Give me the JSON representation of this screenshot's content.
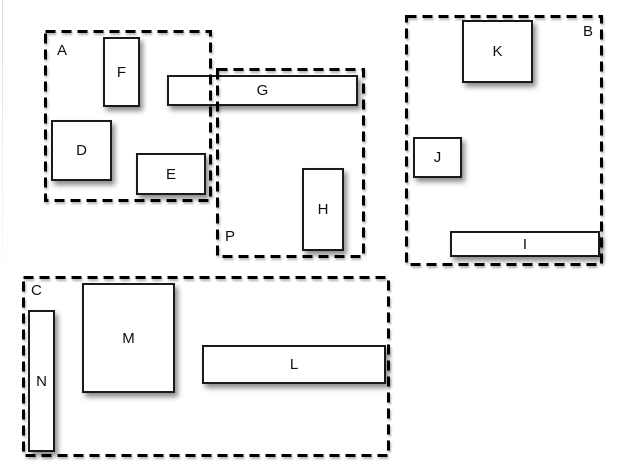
{
  "style": {
    "background": "#ffffff",
    "box_fill": "#ffffff",
    "box_border_color": "#1a1a1a",
    "dash_color": "#000000",
    "label_color": "#101010",
    "shadow_color": "rgba(0,0,0,0.45)"
  },
  "regions": [
    {
      "id": "A",
      "label": "A",
      "label_position": "top-left"
    },
    {
      "id": "P",
      "label": "P",
      "label_position": "bottom-left"
    },
    {
      "id": "B",
      "label": "B",
      "label_position": "top-right"
    },
    {
      "id": "C",
      "label": "C",
      "label_position": "top-left"
    }
  ],
  "boxes": [
    {
      "id": "F",
      "label": "F"
    },
    {
      "id": "D",
      "label": "D"
    },
    {
      "id": "E",
      "label": "E"
    },
    {
      "id": "G",
      "label": "G"
    },
    {
      "id": "H",
      "label": "H"
    },
    {
      "id": "K",
      "label": "K"
    },
    {
      "id": "J",
      "label": "J"
    },
    {
      "id": "I",
      "label": "I"
    },
    {
      "id": "M",
      "label": "M"
    },
    {
      "id": "N",
      "label": "N"
    },
    {
      "id": "L",
      "label": "L"
    }
  ]
}
